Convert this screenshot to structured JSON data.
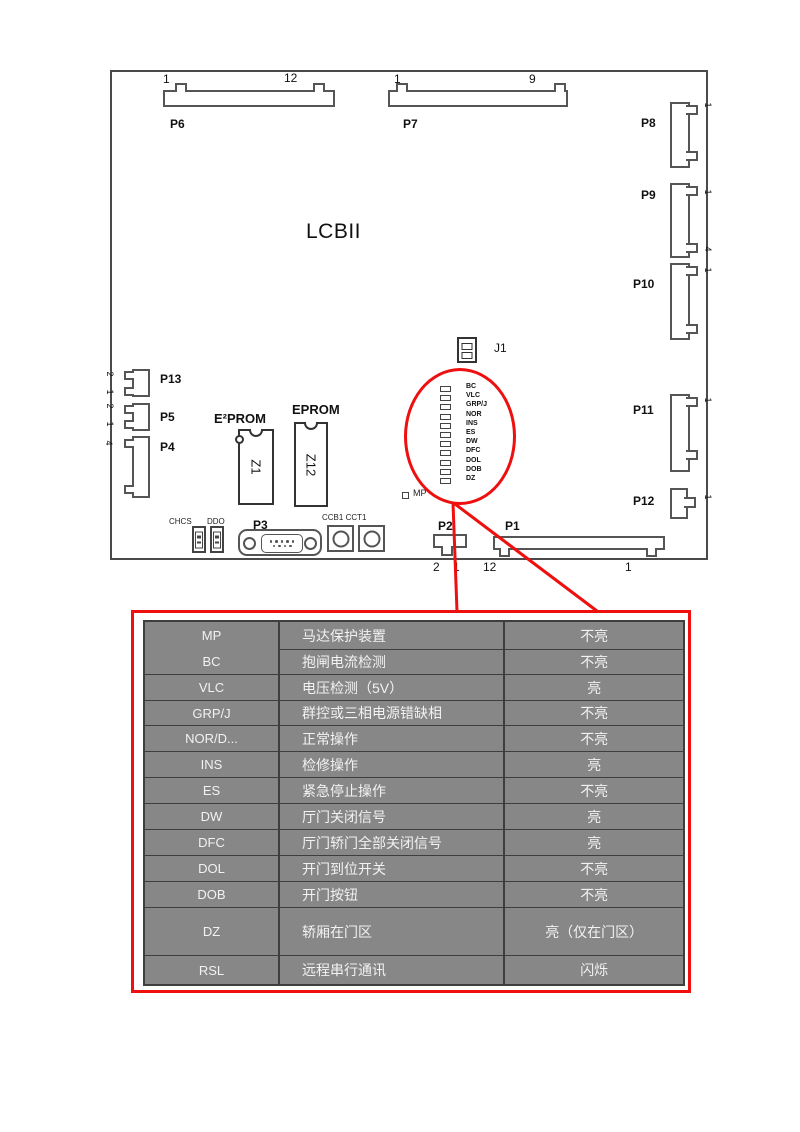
{
  "board": {
    "title": "LCBII",
    "connectors": {
      "p6": {
        "label": "P6",
        "pins": [
          "1",
          "12"
        ]
      },
      "p7": {
        "label": "P7",
        "pins": [
          "1",
          "9"
        ]
      },
      "p8": {
        "label": "P8"
      },
      "p9": {
        "label": "P9"
      },
      "p10": {
        "label": "P10"
      },
      "p11": {
        "label": "P11"
      },
      "p12": {
        "label": "P12"
      },
      "p13": {
        "label": "P13",
        "pins": [
          "2",
          "1"
        ]
      },
      "p5": {
        "label": "P5",
        "pins": [
          "2",
          "1"
        ]
      },
      "p4": {
        "label": "P4",
        "pins": [
          "4"
        ]
      },
      "p2": {
        "label": "P2",
        "pins": [
          "2",
          "1"
        ]
      },
      "p1": {
        "label": "P1",
        "pins": [
          "12",
          "1"
        ]
      },
      "p3": {
        "label": "P3"
      }
    },
    "right_edge_pins": [
      "1",
      "1",
      "4",
      "1",
      "1",
      "1"
    ],
    "chips": {
      "eeprom": {
        "label": "E²PROM",
        "ref": "Z1"
      },
      "eprom": {
        "label": "EPROM",
        "ref": "Z12"
      }
    },
    "jumper_label": "J1",
    "switch_labels": [
      "CHCS",
      "DDO"
    ],
    "round_connectors_label": "CCB1 CCT1",
    "mp_led_label": "MP",
    "led_labels": [
      "BC",
      "VLC",
      "GRP/J",
      "NOR",
      "INS",
      "ES",
      "DW",
      "DFC",
      "DOL",
      "DOB",
      "DZ"
    ]
  },
  "callout": {
    "color": "#ee0f0f"
  },
  "table": {
    "background": "#878787",
    "rows": [
      {
        "led": "MP",
        "desc": "马达保护装置",
        "status": "不亮"
      },
      {
        "led": "BC",
        "desc": "抱闸电流检测",
        "status": "不亮"
      },
      {
        "led": "VLC",
        "desc": "电压检测（5V）",
        "status": "亮"
      },
      {
        "led": "GRP/J",
        "desc": "群控或三相电源错缺相",
        "status": "不亮"
      },
      {
        "led": "NOR/D...",
        "desc": "正常操作",
        "status": "不亮"
      },
      {
        "led": "INS",
        "desc": "检修操作",
        "status": "亮"
      },
      {
        "led": "ES",
        "desc": "紧急停止操作",
        "status": "不亮"
      },
      {
        "led": "DW",
        "desc": "厅门关闭信号",
        "status": "亮"
      },
      {
        "led": "DFC",
        "desc": "厅门轿门全部关闭信号",
        "status": "亮"
      },
      {
        "led": "DOL",
        "desc": "开门到位开关",
        "status": "不亮"
      },
      {
        "led": "DOB",
        "desc": "开门按钮",
        "status": "不亮"
      },
      {
        "led": "DZ",
        "desc": "轿厢在门区",
        "status": "亮（仅在门区）"
      },
      {
        "led": "RSL",
        "desc": "远程串行通讯",
        "status": "闪烁"
      }
    ]
  }
}
